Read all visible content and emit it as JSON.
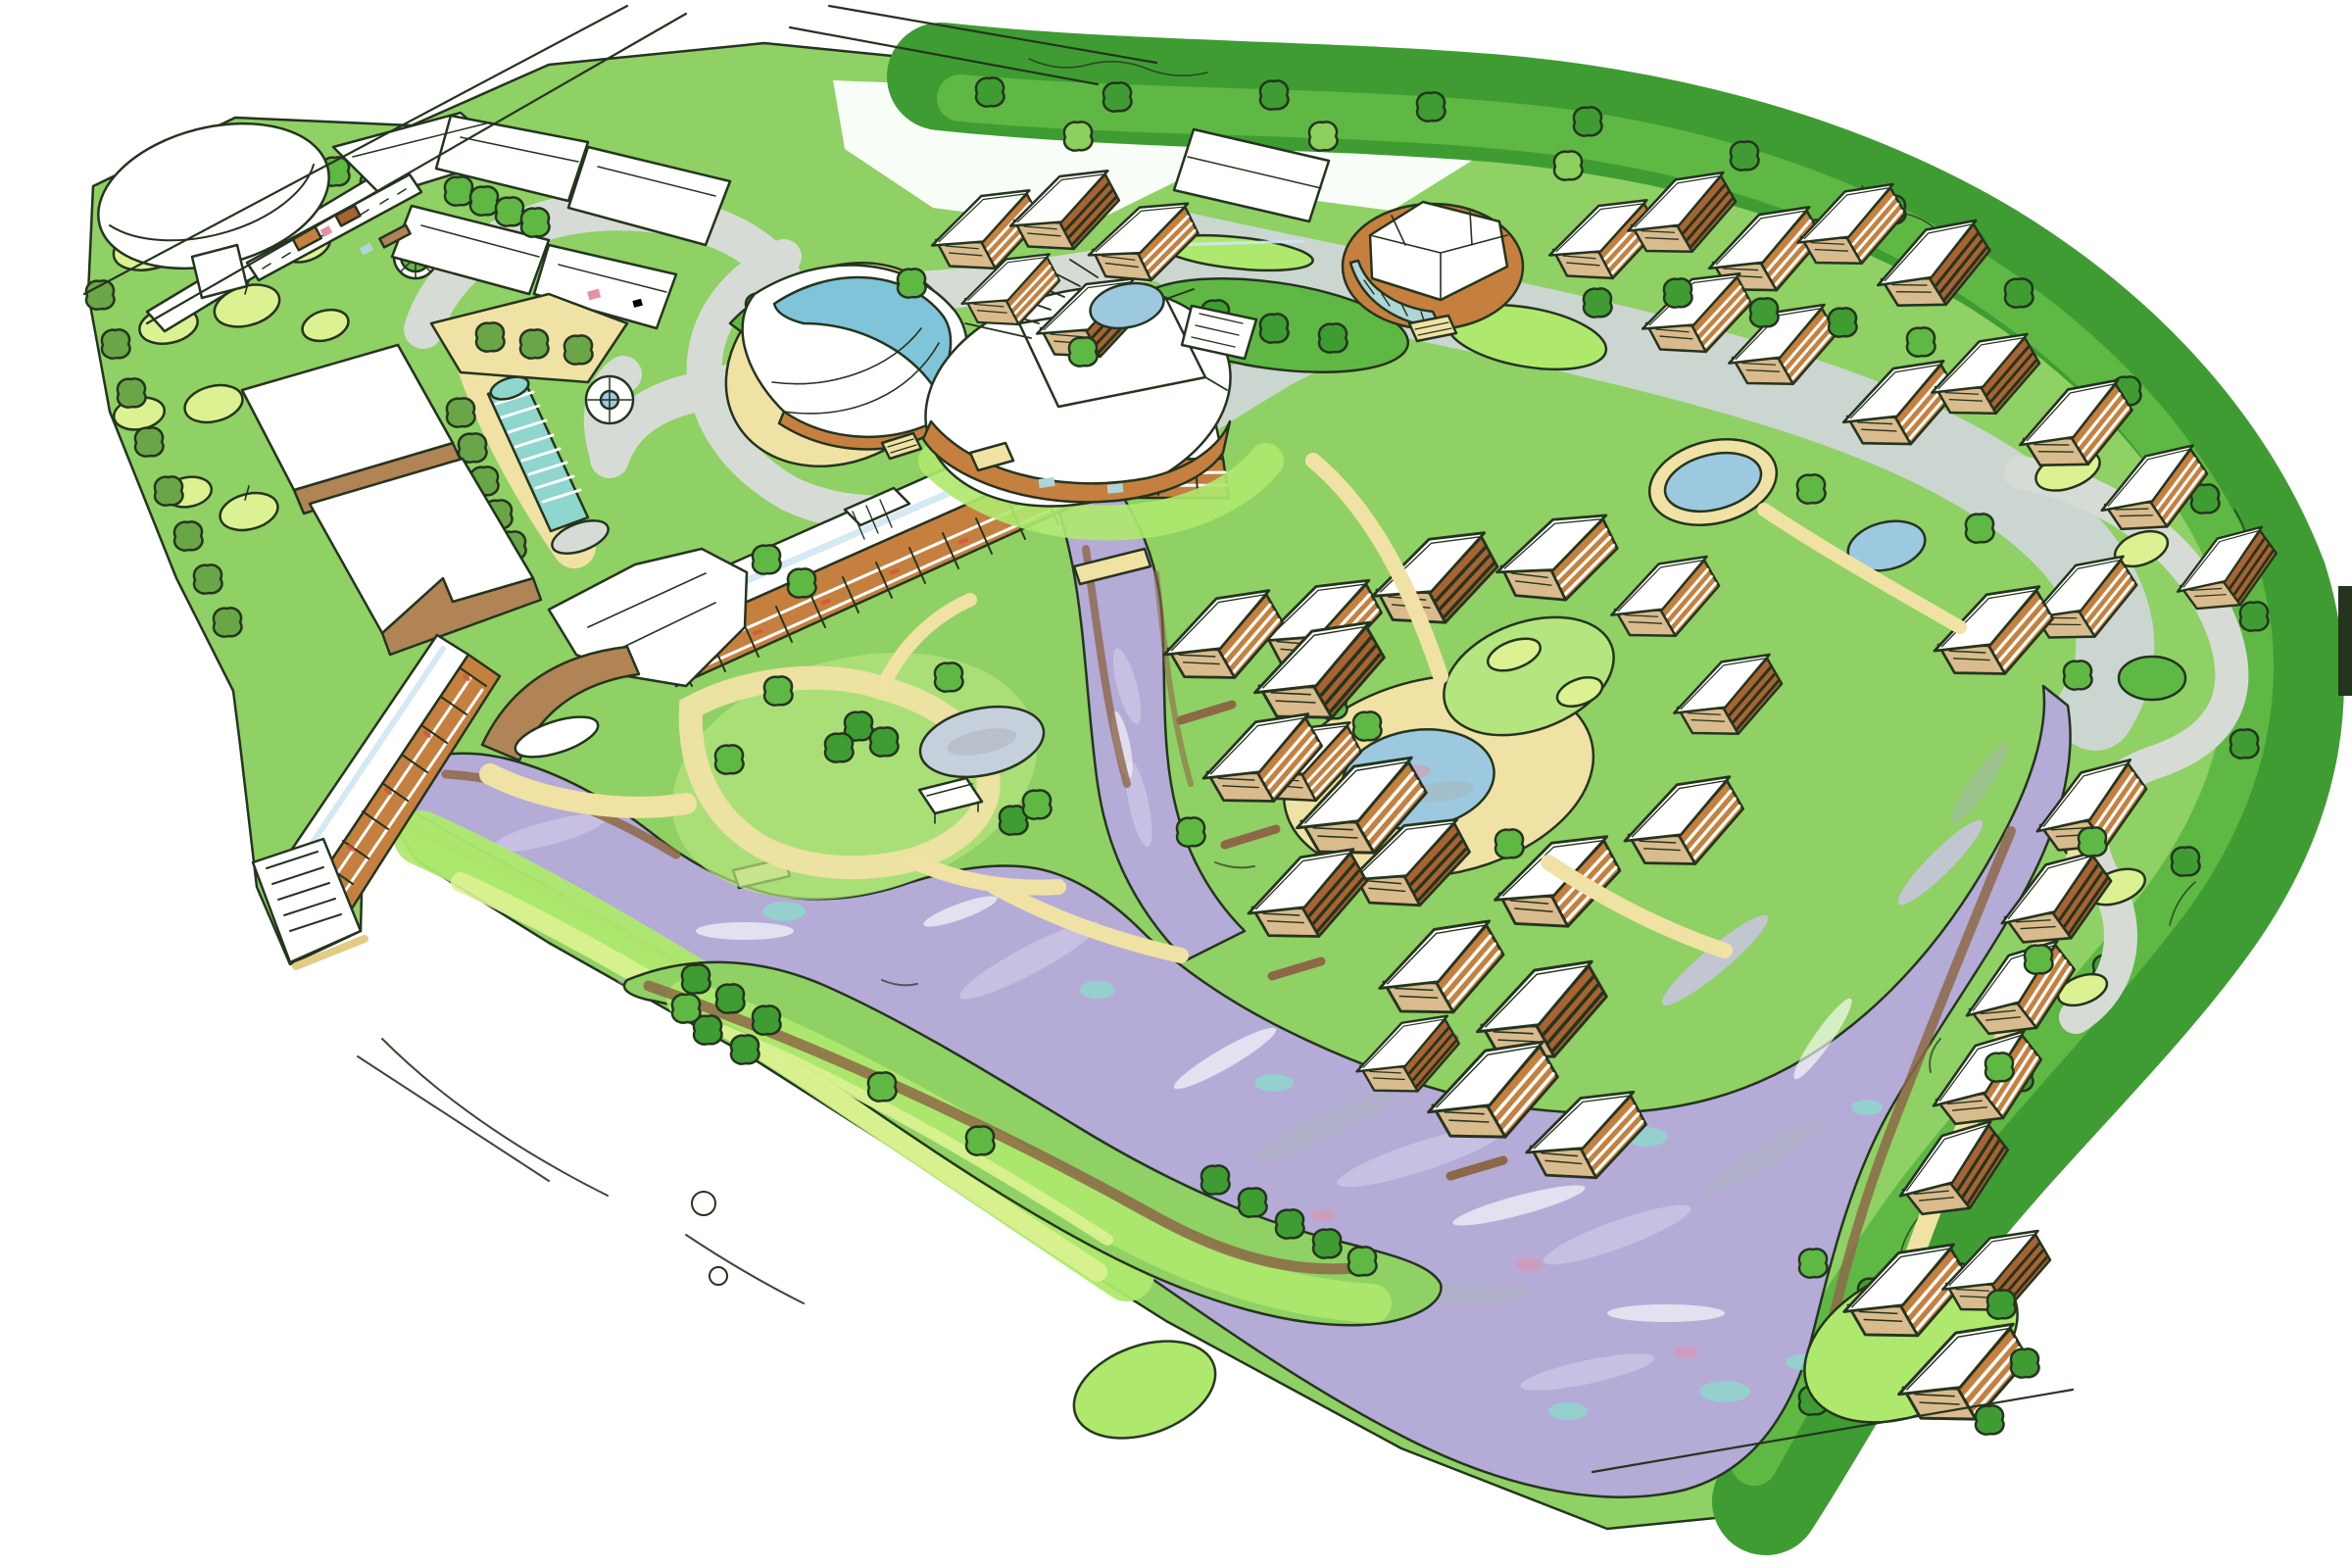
{
  "scene": {
    "kind": "hand-drawn aerial masterplan sketch",
    "medium": "ink and marker illustration, no text labels",
    "view": "aerial three-quarter perspective of a lakeside resort development",
    "features": [
      "conference-centre-with-elliptical-canopy",
      "golf-practice-ground-with-mounds",
      "two-sports-halls",
      "v-shaped-hotel-slab",
      "hotel-entrance-drop-off",
      "leaf-shaped-pool-pavilion",
      "stepped-water-cascade",
      "oval-event-hall",
      "round-drum-pavilion",
      "fountain-roundabouts",
      "road-with-planted-medians",
      "river-corridor",
      "woodland-edge",
      "residential-villa-clusters",
      "central-village-square-with-pond",
      "waterfront-apartment-fingers",
      "lavender-lake",
      "green-island-with-trees",
      "south-east-shore-apartment-row",
      "south-cove-cluster",
      "footpaths-and-bridges",
      "unfinished-white-paper-corners"
    ]
  },
  "palette": {
    "paper": "#ffffff",
    "ink": "#25341f",
    "grass": "#8fd164",
    "grassL": "#b5e57f",
    "grassB": "#aee96e",
    "grassP": "#dcf292",
    "folD": "#3f9c33",
    "folM": "#5fb844",
    "folL": "#8ccf5d",
    "olive": "#6aa647",
    "road": "#d6dcd5",
    "river": "#cbd6d1",
    "lake": "#b4abd7",
    "lakeL": "#cac5e6",
    "streakG": "#a9b4ba",
    "teal": "#8fd6cd",
    "poolB": "#9cc9e0",
    "poolT": "#7fc4d8",
    "pondP": "#c6cfdc",
    "tan": "#f0e2a4",
    "tanD": "#e2cc85",
    "shore": "#b08455",
    "mud": "#8d6847",
    "orange": "#c5803f",
    "terra": "#a96331",
    "btan": "#d9bb8d",
    "glaze": "#aed6d6",
    "sky": "#cfe7f2",
    "red": "#d94f3d",
    "pink": "#e591a4"
  }
}
